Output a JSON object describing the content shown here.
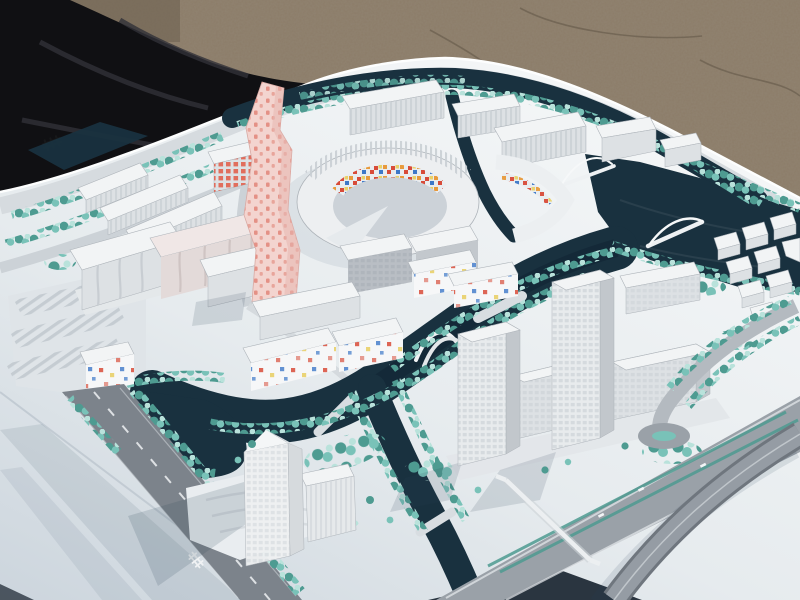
{
  "scene": {
    "type": "photograph",
    "subject": "Architectural scale model of a canal-laced urban masterplan photographed outdoors at an oblique angle",
    "environment": {
      "ground": "brown gravel pavement",
      "covering": "black tarp folded at the upper left",
      "base": "large white model board"
    },
    "landmarks": [
      {
        "name": "pink-tower",
        "description": "twisting high-rise clad in pale pink with darker pink dots"
      },
      {
        "name": "mosaic-courtyard",
        "description": "oval courtyard building with red, blue, orange and yellow facade tiles on its inner ring"
      },
      {
        "name": "confetti-housing",
        "description": "white low-rise housing blocks speckled with red, yellow and blue panels"
      },
      {
        "name": "twin-towers",
        "description": "pair of white grid-facade office towers beside the central canal"
      },
      {
        "name": "south-tower",
        "description": "tall translucent tower with ribbed podium near the lower edge"
      },
      {
        "name": "canal-network",
        "description": "dark teal canals, harbor basin and lake crossed by white arched bridges"
      },
      {
        "name": "tree-rows",
        "description": "turquoise model trees lining roads, banks and parks"
      },
      {
        "name": "boulevard-and-ramp",
        "description": "grey boulevard with teal medians and a curved overpass ramp at lower right"
      },
      {
        "name": "rail-markers",
        "description": "small railway track symbols painted on the roads"
      },
      {
        "name": "parking-lots",
        "description": "striped surface parking rows on the west side"
      }
    ]
  },
  "colors": {
    "gravel": "#8c7c68",
    "gravel_shadow": "#675b4c",
    "tarp": "#101013",
    "tarp_fold": "#313138",
    "board": "#e8ecef",
    "board_high": "#f5f7f8",
    "board_low": "#ccd5dd",
    "water": "#19313f",
    "water_deep": "#0f2230",
    "tree": "#79c2b8",
    "tree_dark": "#4e9b91",
    "tree_light": "#b9e2db",
    "road": "#9aa1a8",
    "road_dark": "#7c838b",
    "road_light": "#d6dbdf",
    "building": "#f2f4f5",
    "building_face": "#dde1e4",
    "building_side": "#c2c7cc",
    "building_line": "#adb3b9",
    "pink": "#f3d4cf",
    "pink_dot": "#e28a7e",
    "pink_side": "#e5b7b0",
    "mosaic_red": "#d84b39",
    "mosaic_blue": "#3d78c8",
    "mosaic_orange": "#e89a3c",
    "mosaic_yellow": "#e9d169",
    "shadow": "#2c4258"
  }
}
